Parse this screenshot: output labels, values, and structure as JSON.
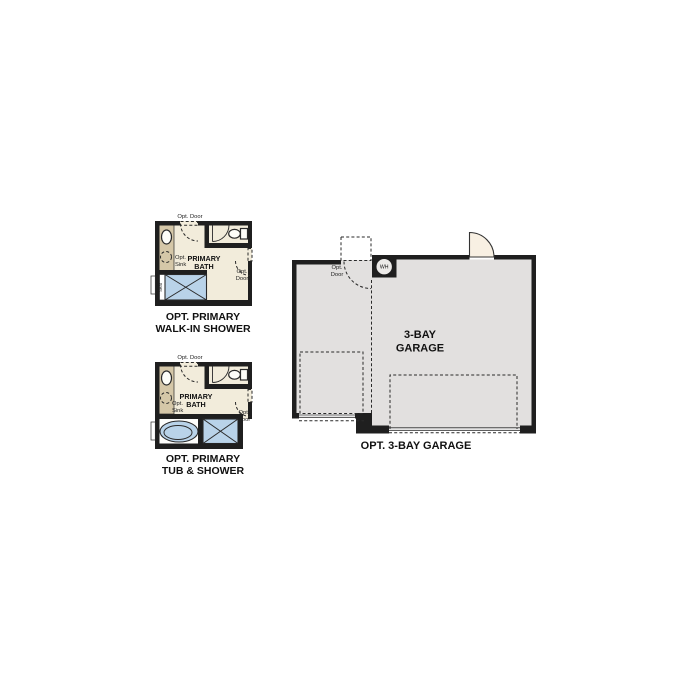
{
  "palette": {
    "wall": "#1f1f1f",
    "bath_floor": "#f2ecdb",
    "vanity_tan": "#d5c7a8",
    "fixture_blue": "#b9d3e9",
    "garage_floor": "#e2e0df",
    "door_swing_fill": "#f8f0e3",
    "text": "#111111"
  },
  "walk_in_shower": {
    "title_line1": "OPT. PRIMARY",
    "title_line2": "WALK-IN SHOWER",
    "room_line1": "PRIMARY",
    "room_line2": "BATH",
    "opt_door_top": "Opt. Door",
    "opt_sink_line1": "Opt.",
    "opt_sink_line2": "Sink",
    "opt_door_right_line1": "Opt.",
    "opt_door_right_line2": "Door",
    "seat": "Seat"
  },
  "tub_shower": {
    "title_line1": "OPT. PRIMARY",
    "title_line2": "TUB & SHOWER",
    "room_line1": "PRIMARY",
    "room_line2": "BATH",
    "opt_door_top": "Opt. Door",
    "opt_sink_line1": "Opt.",
    "opt_sink_line2": "Sink",
    "opt_door_right_line1": "Opt.",
    "opt_door_right_line2": "Door"
  },
  "garage": {
    "title": "OPT. 3-BAY GARAGE",
    "room_line1": "3-BAY",
    "room_line2": "GARAGE",
    "opt_door_line1": "Opt.",
    "opt_door_line2": "Door",
    "water_heater": "WH"
  }
}
